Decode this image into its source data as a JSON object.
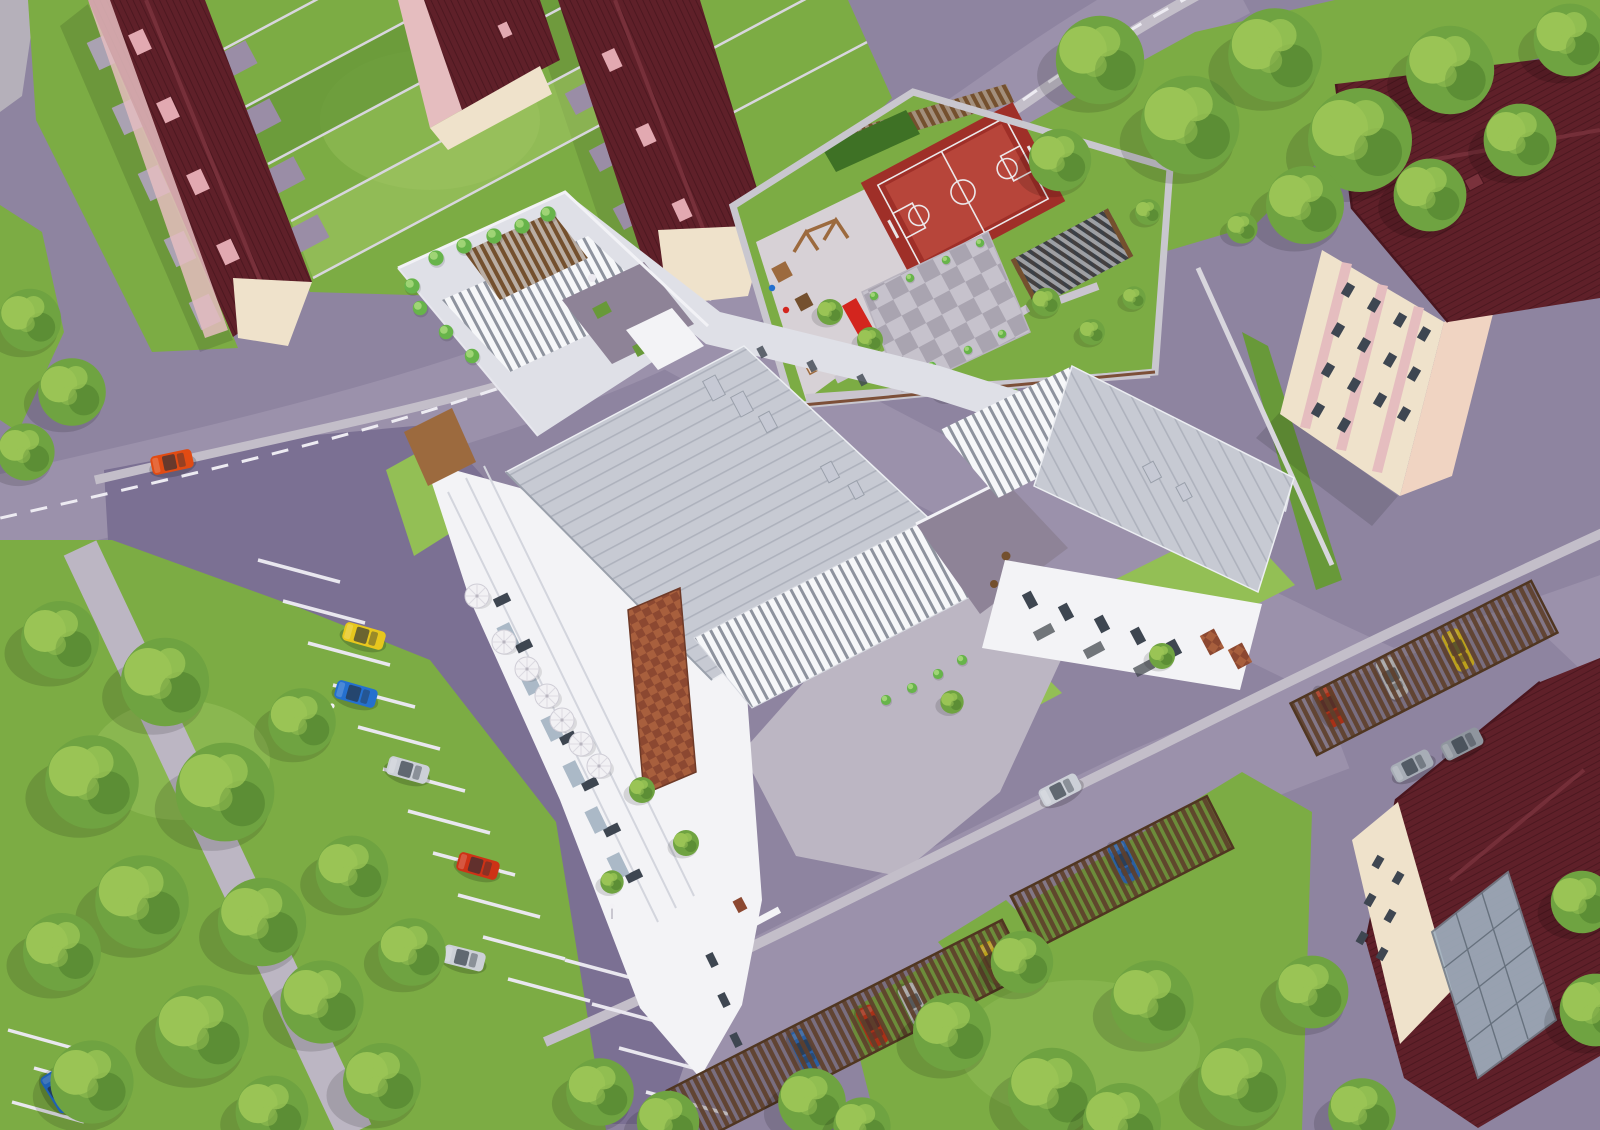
{
  "scene": {
    "kind": "aerial 3D architectural rendering",
    "subject": "modern white residential apartment complex with courtyard amenities, surrounded by row houses, streets, parking and mature trees",
    "view": "top-down oblique bird's-eye view",
    "text_content": "none - image contains no readable text"
  },
  "palette": {
    "asphalt": "#8e84a0",
    "road": "#9b91ab",
    "lot": "#7b7093",
    "sidewalk": "#c3bec9",
    "path": "#bcb6c3",
    "grass": "#7cac44",
    "grassLight": "#93bf55",
    "grassDark": "#689939",
    "grassPale": "#a5ca67",
    "tree": "#6fa341",
    "treeLight": "#9ac455",
    "treeDark": "#4d7d2c",
    "shrub": "#67b44a",
    "maroon": "#5f2029",
    "maroonLight": "#7a323c",
    "dormerPink": "#e2a9b1",
    "cream": "#efe2cb",
    "pinkWall": "#e5bdbf",
    "peach": "#f0d4c2",
    "white": "#f3f3f6",
    "whiteShade": "#dfe0e7",
    "whiteDark": "#c6c9d4",
    "metal": "#c7cad3",
    "metalSeam": "#aeb2bd",
    "louver": "#f6f7f9",
    "louverGap": "#8e939e",
    "terracePurple": "#8e8397",
    "brick": "#a85f3d",
    "brickDark": "#8c4831",
    "courtRed": "#9f2f28",
    "courtRedLight": "#b7453a",
    "courtLine": "#ece8ea",
    "paving": "#d7d1d6",
    "wood": "#9c6a3e",
    "woodDark": "#74502e",
    "slideRed": "#d3251e",
    "pergolaDark": "#3b4047",
    "carportBrown": "#5e3f2b",
    "hedge": "#3e7125",
    "wallGray": "#c9c7cf",
    "fence": "#d8d6dd",
    "umbrella": "#f2f1f4",
    "windowDark": "#3e4651",
    "glass": "#9fb0bf",
    "carYellow": "#e7c71d",
    "carBlue": "#2470cf",
    "carSilver": "#ccd0d7",
    "carRed": "#cd3216",
    "carOrange": "#e14b13",
    "carGray": "#a7adb6",
    "carGrayDark": "#8f959e",
    "dashWhite": "#edebf2",
    "stripeWhite": "#e9e7ef"
  },
  "buildings": [
    {
      "name": "row-house-west",
      "roof": "dark maroon tile",
      "walls": "cream with pink dormers"
    },
    {
      "name": "house-north-small",
      "roof": "dark maroon tile",
      "walls": "pink and cream"
    },
    {
      "name": "row-house-east",
      "roof": "dark maroon tile",
      "walls": "cream with pink dormers"
    },
    {
      "name": "main-apartment-building",
      "roof": "light gray standing-seam metal with white louvered pergolas",
      "walls": "white",
      "accents": "brick panels, glass balconies, rooftop terraces with planted trees"
    },
    {
      "name": "pink-apartment-building-east",
      "roof": "dark maroon tile",
      "walls": "cream with pink bands"
    },
    {
      "name": "house-southeast",
      "roof": "dark maroon tile",
      "walls": "cream",
      "feature": "glass conservatory"
    }
  ],
  "amenities": [
    "red basketball court with white markings",
    "children playground with wooden equipment and red slide",
    "checkerboard paved plaza with planters",
    "dark pergola with white slats",
    "rooftop terraces with shrubs and furniture",
    "cafe terrace with white umbrellas",
    "covered carports with slatted roofs",
    "surface parking with white stripes"
  ],
  "vehicles": [
    {
      "color": "orange",
      "hex": "#e14b13",
      "location": "northwest road"
    },
    {
      "color": "yellow",
      "hex": "#e7c71d",
      "location": "west parking lot"
    },
    {
      "color": "blue",
      "hex": "#2470cf",
      "location": "west parking lot"
    },
    {
      "color": "silver",
      "hex": "#ccd0d7",
      "location": "west parking lot"
    },
    {
      "color": "red",
      "hex": "#cd3216",
      "location": "west parking lot"
    },
    {
      "color": "silver",
      "hex": "#ccd0d7",
      "location": "west parking lot south"
    },
    {
      "color": "blue",
      "hex": "#2470cf",
      "location": "southwest corner road"
    },
    {
      "color": "silver",
      "hex": "#ccd0d7",
      "location": "inner drive"
    },
    {
      "color": "gray",
      "hex": "#a7adb6",
      "location": "southeast street"
    },
    {
      "color": "gray",
      "hex": "#8f959e",
      "location": "southeast street"
    },
    {
      "color": "blue",
      "hex": "#2470cf",
      "location": "carport south"
    },
    {
      "color": "red",
      "hex": "#cd3216",
      "location": "carport south"
    },
    {
      "color": "silver",
      "hex": "#ccd0d7",
      "location": "carport south"
    },
    {
      "color": "yellow",
      "hex": "#e7c71d",
      "location": "carport south"
    },
    {
      "color": "blue",
      "hex": "#2470cf",
      "location": "carport middle"
    },
    {
      "color": "red",
      "hex": "#cd3216",
      "location": "carport east"
    },
    {
      "color": "silver",
      "hex": "#ccd0d7",
      "location": "carport east"
    },
    {
      "color": "yellow",
      "hex": "#e7c71d",
      "location": "carport east"
    }
  ],
  "vegetation": {
    "large_tree_clusters": [
      "northeast",
      "southwest park",
      "south center",
      "southeast",
      "west edge"
    ],
    "rooftop_planters": "rows of small bright-green trees",
    "courtyard": "small trees, hedge, lawns"
  }
}
